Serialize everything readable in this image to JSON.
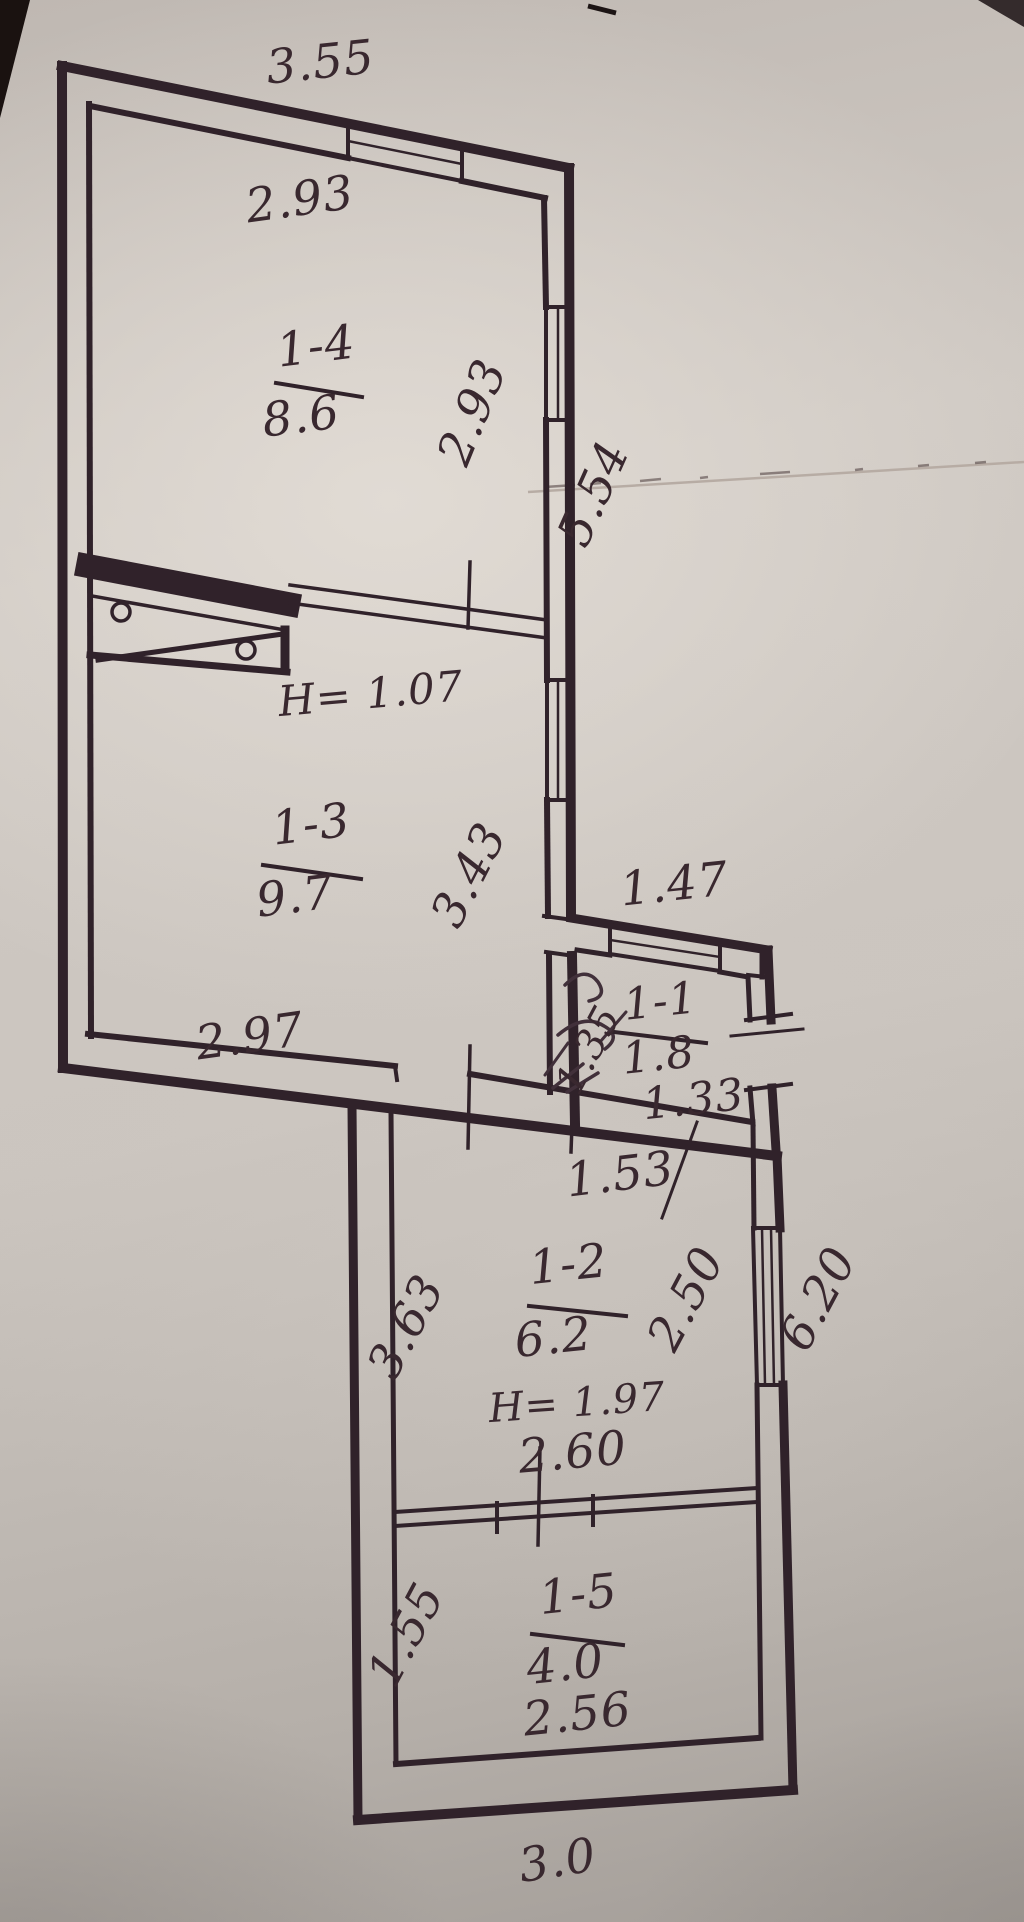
{
  "plan": {
    "rooms": [
      {
        "number": "1-4",
        "area": "8.6"
      },
      {
        "number": "1-3",
        "area": "9.7"
      },
      {
        "number": "1-1",
        "area": "1.8"
      },
      {
        "number": "1-2",
        "area": "6.2"
      },
      {
        "number": "1-5",
        "area": "4.0"
      }
    ],
    "heights": {
      "passage": "H= 1.07",
      "room_1_2": "H= 1.97"
    },
    "dimensions": {
      "top_overall": "3.55",
      "room_1_4_width": "2.93",
      "room_1_4_depth": "2.93",
      "right_side_upper": "5.54",
      "room_1_3_depth": "3.43",
      "room_1_3_width": "2.97",
      "annex_width_top": "1.47",
      "room_1_1_depth": "1.35",
      "room_1_1_width": "1.33",
      "annex_width_bottom": "1.53",
      "room_1_2_left_depth": "3.63",
      "room_1_2_right_depth": "2.50",
      "right_side_lower": "6.20",
      "partition_width": "2.60",
      "room_1_5_left_depth": "1.55",
      "room_1_5_width": "2.56",
      "bottom_overall": "3.0",
      "left_edge_partial": "8"
    },
    "colors": {
      "ink": "#30222a",
      "paper": "#cfc9c3"
    }
  }
}
